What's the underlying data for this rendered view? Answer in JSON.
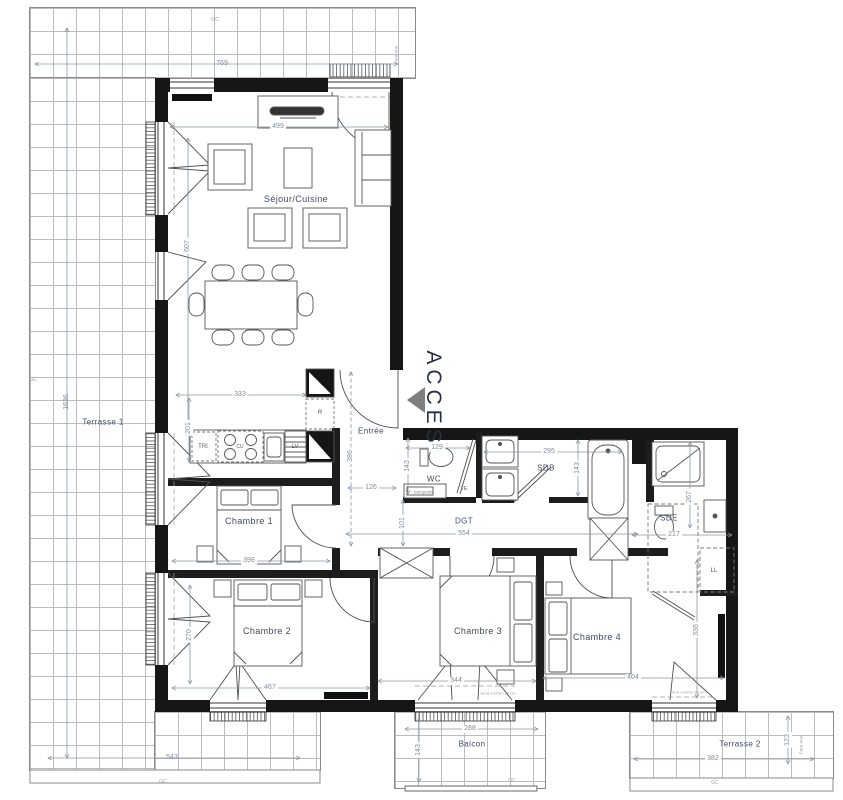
{
  "plan": {
    "access_label": "ACCES",
    "rooms": {
      "sejour": "Séjour/Cuisine",
      "entree": "Entrée",
      "wc": "WC",
      "sdb": "SDB",
      "sde": "SDE",
      "dgt": "DGT",
      "chambre1": "Chambre 1",
      "chambre2": "Chambre 2",
      "chambre3": "Chambre 3",
      "chambre4": "Chambre 4",
      "terrasse1": "Terrasse 1",
      "terrasse2": "Terrasse 2",
      "balcon": "Balcon"
    },
    "equipment": {
      "tri": "TRI",
      "cu": "CU",
      "lv": "LV",
      "r": "R",
      "ll": "LL",
      "te": "TE",
      "banquette": "banquette"
    },
    "annotations": {
      "gc": "GC",
      "pare_vue": "Pare-vue",
      "seuil": "Seuil environ 15 cm"
    },
    "dims": {
      "terrasse1_top": "769",
      "terrasse1_left": "1636",
      "terrasse1_bottom": "543",
      "sejour_w": "499",
      "sejour_h": "607",
      "kitchen_w": "333",
      "kitchen_h": "201",
      "entree_h": "386",
      "entree_w": "126",
      "wc_w": "129",
      "wc_h": "143",
      "sdb_w": "295",
      "sdb_h": "143",
      "dgt_w": "554",
      "dgt_h": "101",
      "sde_w": "217",
      "sde_h": "267",
      "chambre1_w": "398",
      "chambre2_w": "467",
      "chambre2_h": "270",
      "chambre3_w": "344",
      "chambre4_w": "404",
      "chambre4_h": "336",
      "balcon_w": "288",
      "balcon_h": "143",
      "terrasse2_w": "382",
      "terrasse2_h": "123"
    },
    "colors": {
      "wall": "#161616",
      "label": "#3e4c63",
      "dim": "#7f8da3",
      "access_triangle": "#7e7e7e",
      "terrace_grid": "#bcbcbc"
    }
  }
}
